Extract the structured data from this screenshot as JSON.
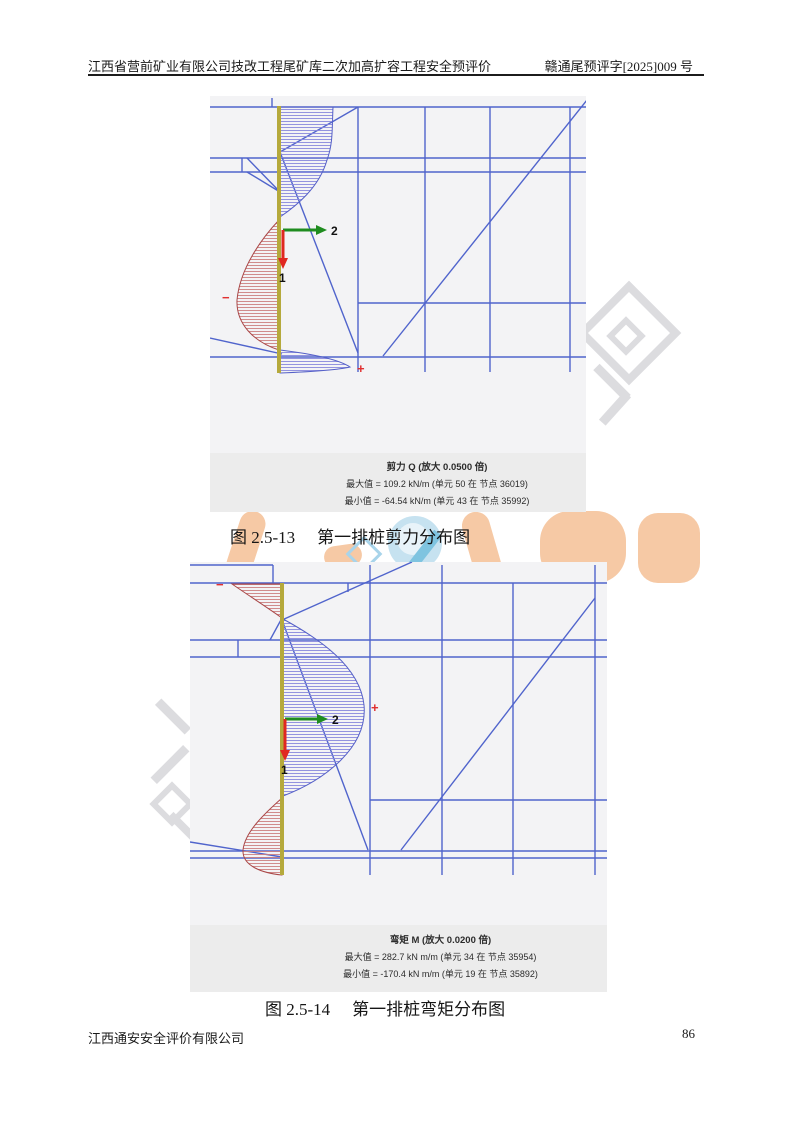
{
  "header": {
    "left_title": "江西省营前矿业有限公司技改工程尾矿库二次加高扩容工程安全预评价",
    "right_code": "赣通尾预评字[2025]009 号"
  },
  "footer": {
    "company": "江西通安安全评价有限公司",
    "page_number": "86"
  },
  "figures": [
    {
      "caption_label": "图 2.5-13",
      "caption_title": "第一排桩剪力分布图",
      "stats_title": "剪力 Q (放大 0.0500 倍)",
      "stats_max": "最大值 = 109.2 kN/m (单元 50 在 节点 36019)",
      "stats_min": "最小值 = -64.54 kN/m (单元 43 在 节点 35992)",
      "axis_label_1": "1",
      "axis_label_2": "2",
      "plus_marker": "+",
      "minus_marker": "−"
    },
    {
      "caption_label": "图 2.5-14",
      "caption_title": "第一排桩弯矩分布图",
      "stats_title": "弯矩 M (放大 0.0200 倍)",
      "stats_max": "最大值 = 282.7 kN m/m (单元 34 在 节点 35954)",
      "stats_min": "最小值 = -170.4 kN m/m (单元 19 在 节点 35892)",
      "axis_label_1": "1",
      "axis_label_2": "2",
      "plus_marker": "+",
      "minus_marker": "−"
    }
  ],
  "colors": {
    "mesh_line": "#5064cc",
    "pile": "#b5a93c",
    "shear_positive_hatch": "#8888dd",
    "shear_negative_hatch": "#cc8080",
    "axis_1_arrow": "#e02820",
    "axis_2_arrow": "#1f8c1f",
    "sign_marker": "#e03030",
    "figure_background": "#f3f3f5",
    "stats_band_background": "#ececec",
    "watermark_peach": "#f6c9a5",
    "watermark_blue": "#c6e2f0",
    "watermark_gray": "#dcdcdf"
  }
}
